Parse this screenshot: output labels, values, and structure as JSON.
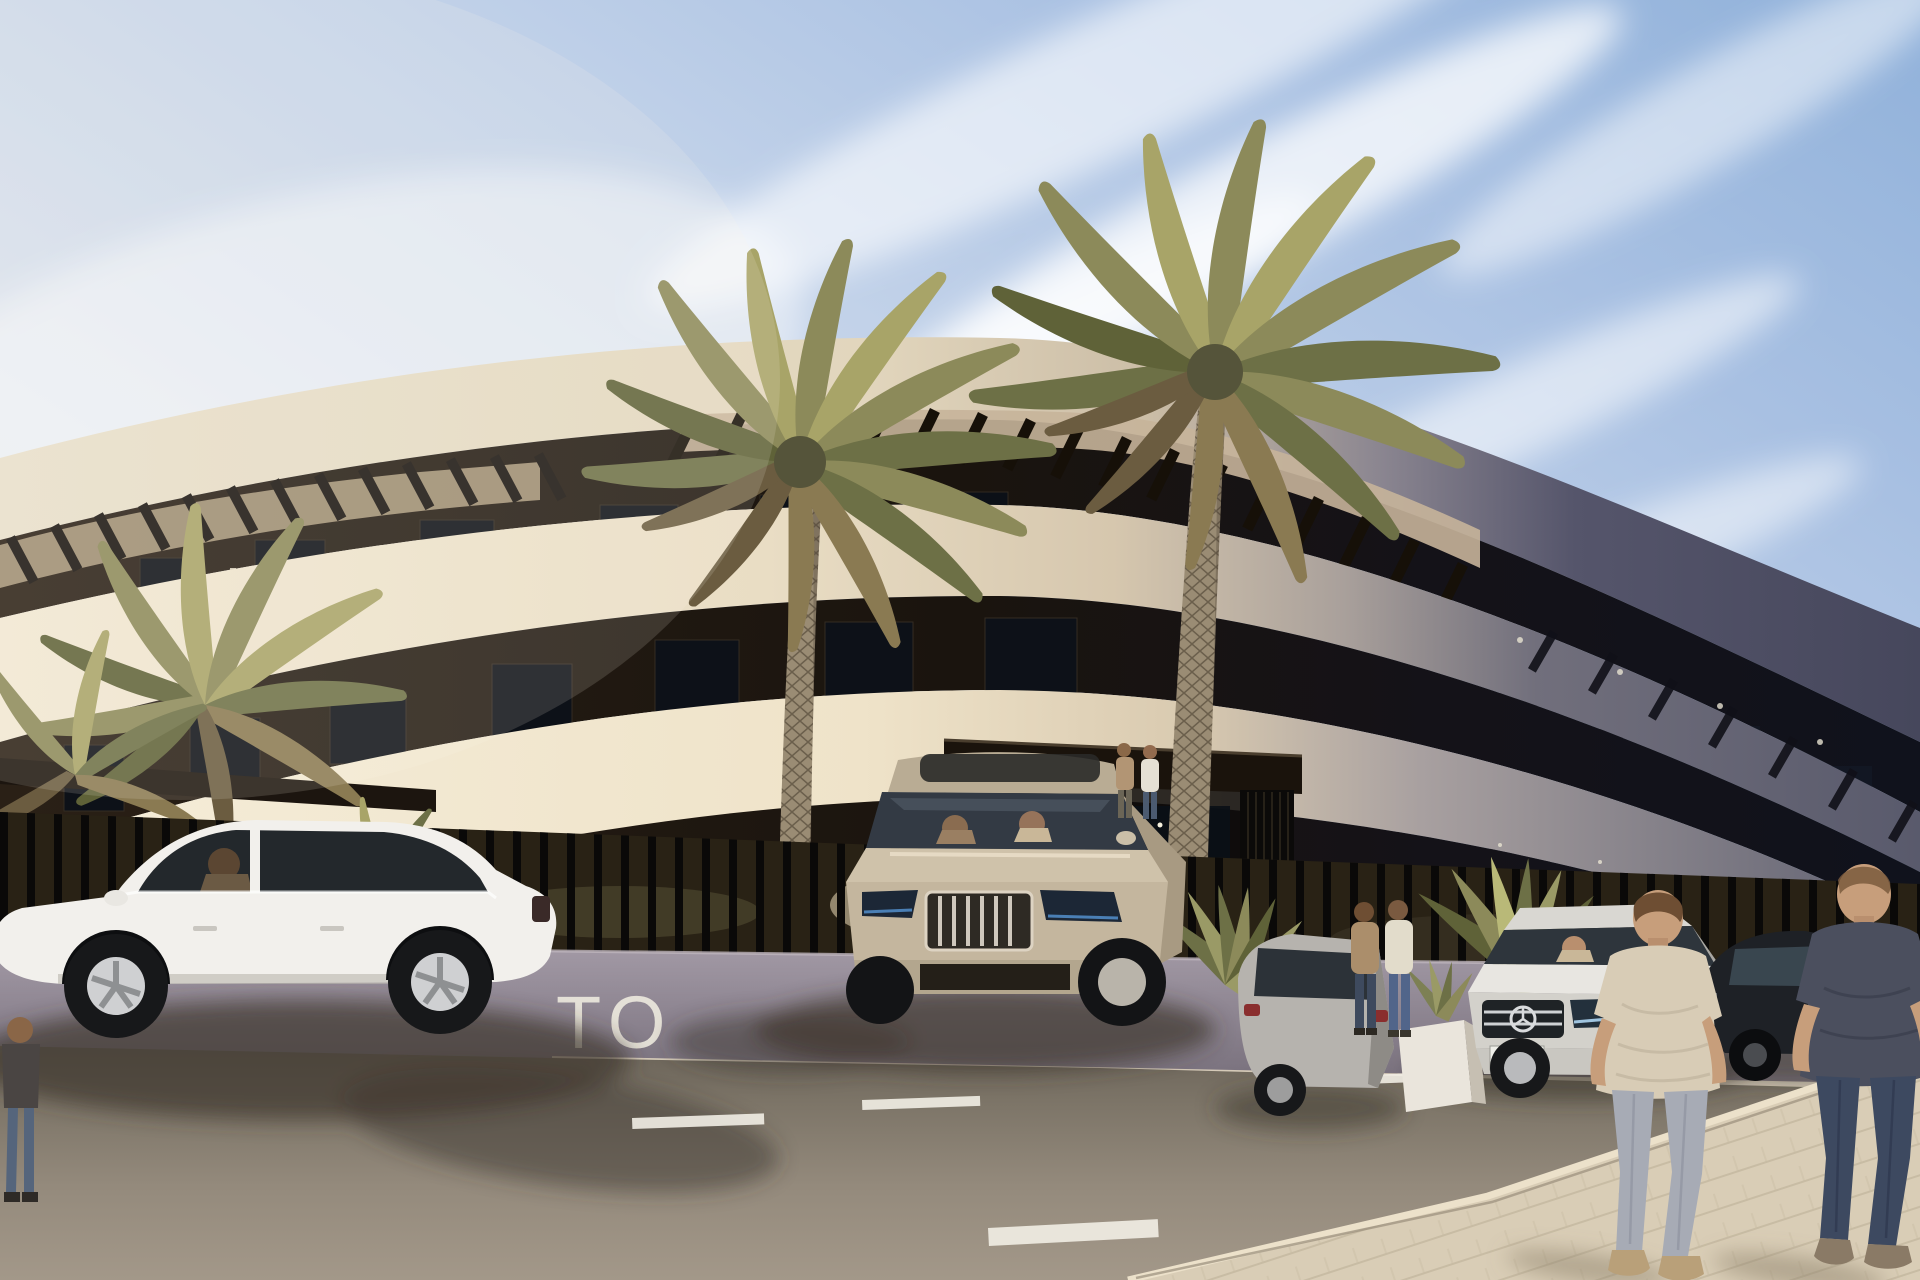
{
  "scene": {
    "type": "architectural-exterior-render",
    "description": "Sunny daytime render of a modern curved white apartment building with dark recessed floors and pergola slats, black slatted fence on a low wall, two tall palm trees, five parked cars, and pedestrians on a road and paved sidewalk",
    "lighting": "sun from left, right facade side in blue-grey shadow"
  },
  "sign": {
    "visible_text": "TO",
    "color": "#ece8dd"
  },
  "palette": {
    "sky_left": "#ece9e4",
    "sky_right": "#90b1da",
    "cloud": "#ffffff",
    "building_cream": "#efe5d0",
    "building_dark_floor": "#1a140e",
    "building_shadow_side": "#595a6c",
    "pergola_slat": "#161008",
    "fence_bar": "#0a0908",
    "hedge": "#292215",
    "wall": "#948b97",
    "curb": "#d5cab8",
    "road": "#8d8274",
    "road_marking": "#f2efe6",
    "sidewalk": "#d9cdb6",
    "palm_frond": "#8c8a5a",
    "palm_trunk": "#9a8c74",
    "car_white": "#f2f0ec",
    "car_champagne": "#cfc2aa",
    "car_gray": "#b6b3ae",
    "car_silver": "#e8e6e1",
    "car_black": "#1e2126",
    "skin": "#c79e7b",
    "tee_beige": "#d8ccb6",
    "tee_dark": "#4b4f5e",
    "jeans_light": "#a7abb5",
    "jeans_dark": "#3d4960"
  },
  "objects": {
    "building": "curved 3-storey apartment block, cream slabs, dark recessed floors, rooftop pergola slats, entrance canopy",
    "vehicles": [
      "white sedan side view left",
      "champagne SUV centre",
      "grey hatchback rear view",
      "silver sedan with grille star",
      "black sedan right"
    ],
    "people": [
      "man standing far left",
      "driver in white sedan",
      "two occupants in SUV",
      "two small figures at gate walkway",
      "two visitors by white planter",
      "driver in silver sedan",
      "two men walking away on sidewalk"
    ],
    "vegetation": [
      "palm cluster behind left fence",
      "two tall centre palms",
      "small palm behind wall",
      "spiky shrubs at entrance",
      "agave in white planter"
    ]
  }
}
